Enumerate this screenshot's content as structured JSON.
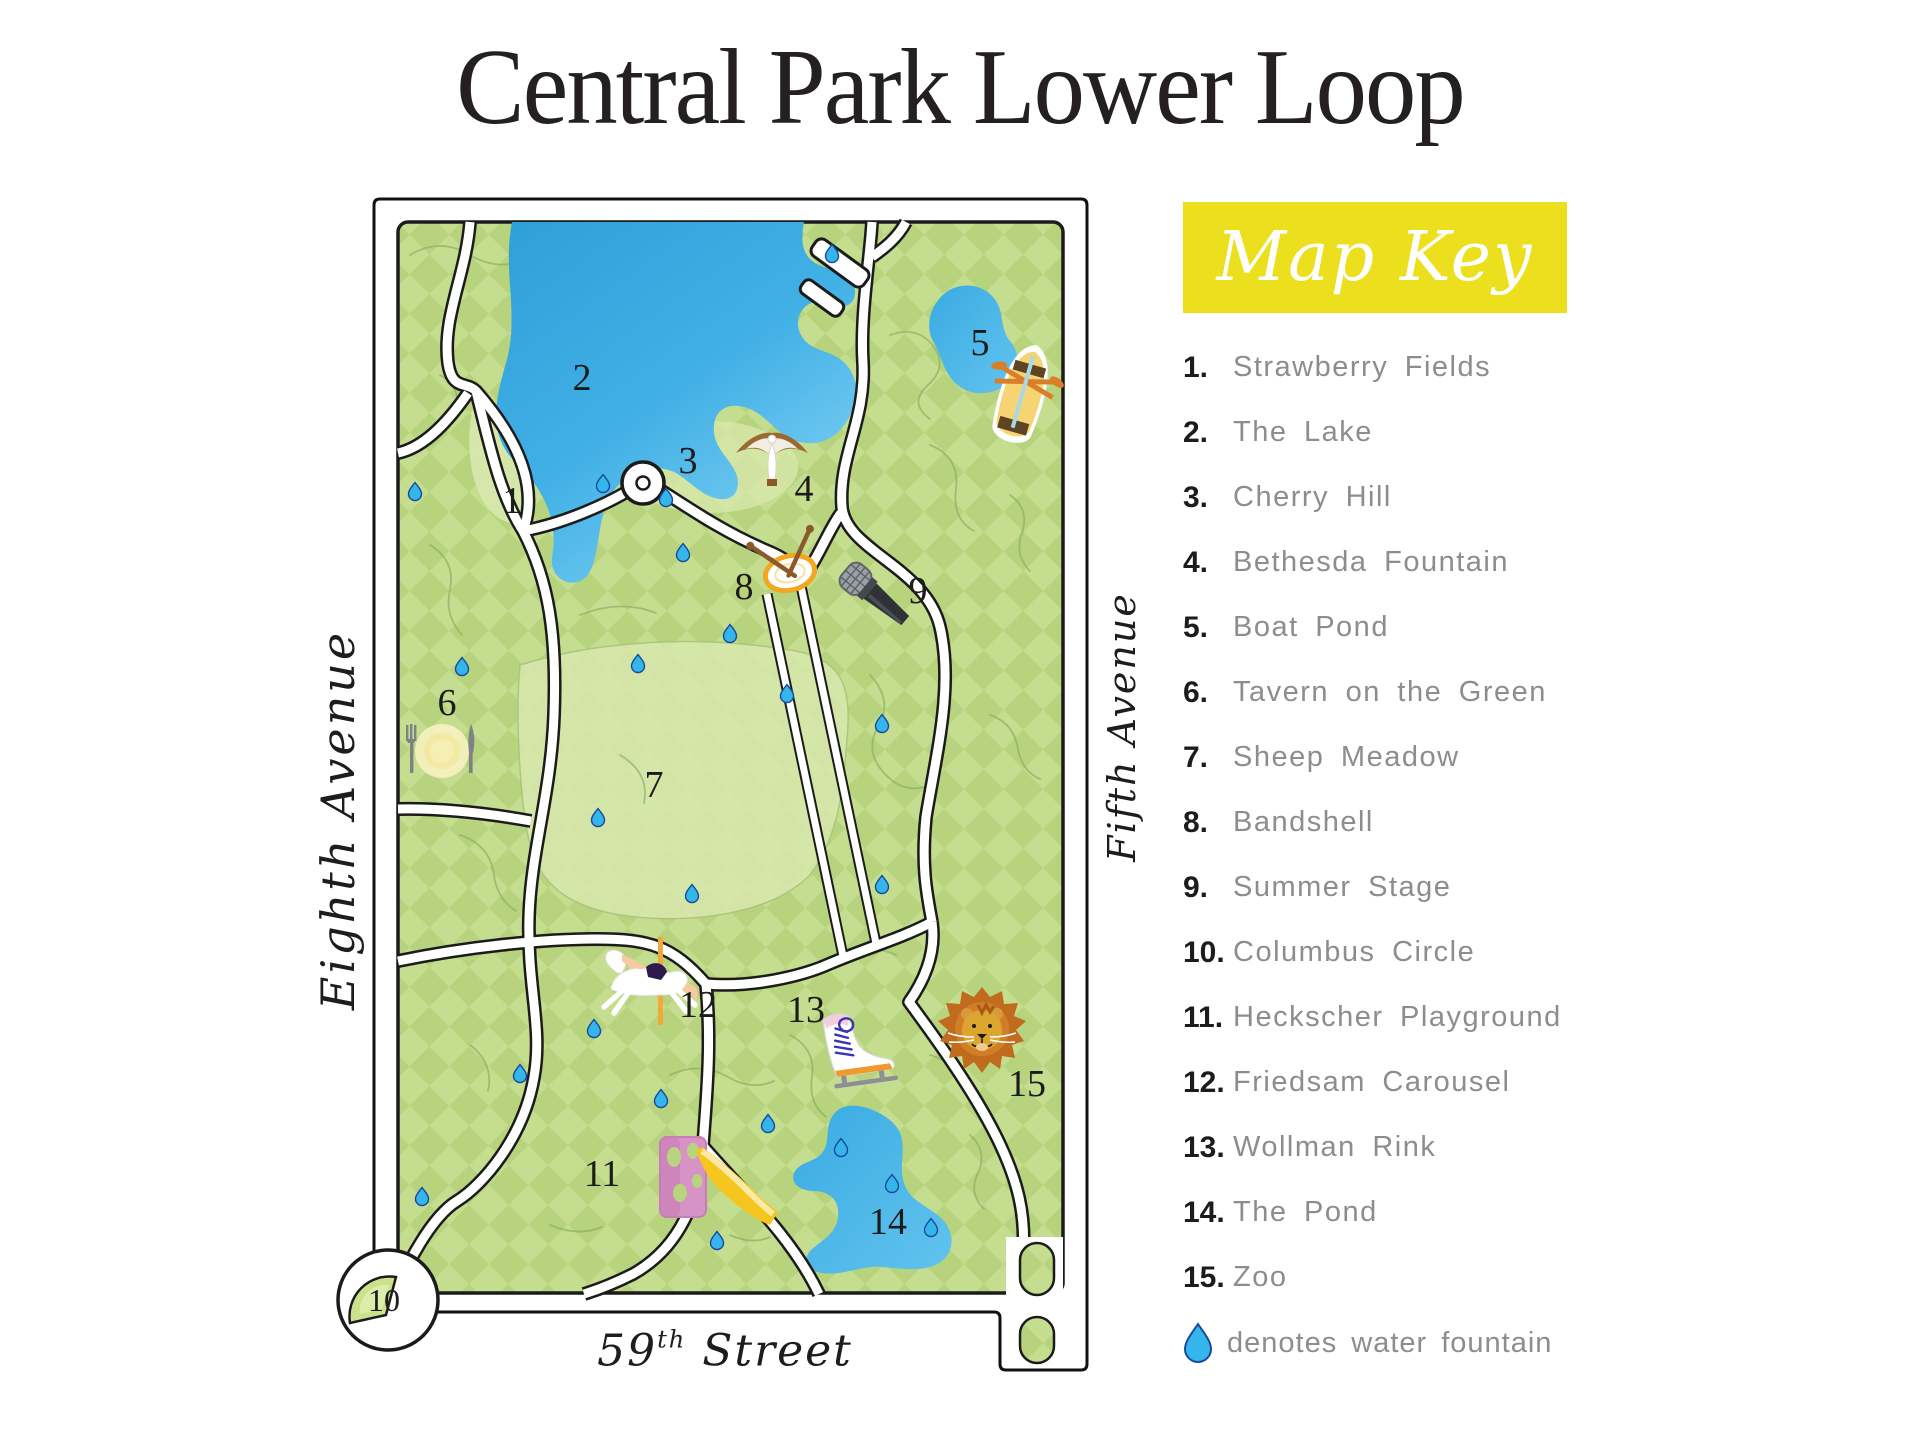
{
  "title": "Central Park Lower Loop",
  "colors": {
    "key_header_bg": "#ecdf1d",
    "key_header_text": "#ffffff",
    "key_label_text": "#8d8d8d",
    "park_green": "#b8d37d",
    "park_green_light": "#c5dd8e",
    "lake_blue": "#3aa9e1",
    "water_drop_blue": "#35b6ea",
    "ink": "#242021"
  },
  "map": {
    "west_label": "Eighth Avenue",
    "east_label": "Fifth Avenue",
    "south_label": {
      "number": "59",
      "ordinal": "th",
      "street": "Street"
    },
    "markers": [
      "1",
      "2",
      "3",
      "4",
      "5",
      "6",
      "7",
      "8",
      "9",
      "10",
      "11",
      "12",
      "13",
      "14",
      "15"
    ]
  },
  "key": {
    "header": "Map Key",
    "items": [
      {
        "number": "1.",
        "label": "Strawberry Fields"
      },
      {
        "number": "2.",
        "label": "The Lake"
      },
      {
        "number": "3.",
        "label": "Cherry Hill"
      },
      {
        "number": "4.",
        "label": "Bethesda Fountain"
      },
      {
        "number": "5.",
        "label": "Boat Pond"
      },
      {
        "number": "6.",
        "label": "Tavern on the Green"
      },
      {
        "number": "7.",
        "label": "Sheep Meadow"
      },
      {
        "number": "8.",
        "label": "Bandshell"
      },
      {
        "number": "9.",
        "label": "Summer Stage"
      },
      {
        "number": "10.",
        "label": "Columbus Circle"
      },
      {
        "number": "11.",
        "label": "Heckscher Playground"
      },
      {
        "number": "12.",
        "label": "Friedsam Carousel"
      },
      {
        "number": "13.",
        "label": "Wollman Rink"
      },
      {
        "number": "14.",
        "label": "The Pond"
      },
      {
        "number": "15.",
        "label": "Zoo"
      }
    ],
    "note": "denotes water fountain"
  }
}
